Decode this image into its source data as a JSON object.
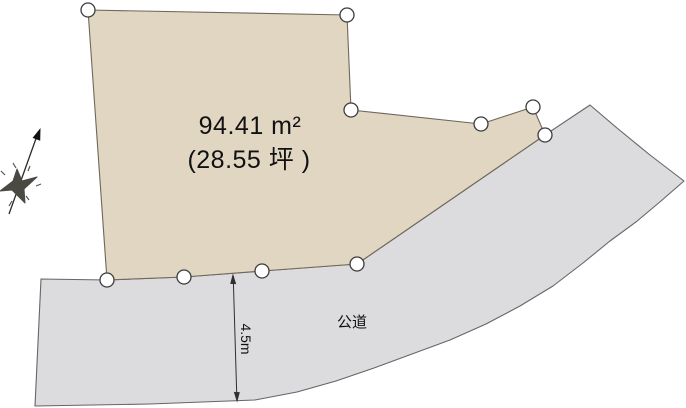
{
  "diagram": {
    "background_color": "#ffffff",
    "parcel": {
      "area_sqm": "94.41 m²",
      "area_tsubo": "(28.55 坪 )",
      "fill_color": "#e1d6c2"
    },
    "road": {
      "label": "公道",
      "fill_color": "#dcdcde"
    },
    "dimension": {
      "label": "4.5m",
      "line_color": "#2f2f2f"
    },
    "survey_point": {
      "fill_color": "#ffffff"
    }
  }
}
